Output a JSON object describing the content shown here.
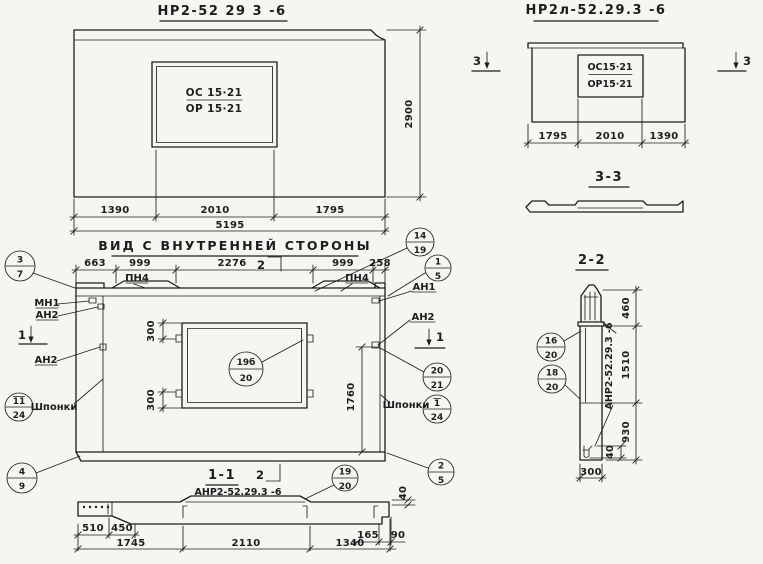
{
  "paper_color": "#f6f5f1",
  "ink_color": "#1d1d1d",
  "front_left": {
    "title": "НР2-52 29 3 -6",
    "opening_top": "ОС 15·21",
    "opening_bottom": "ОР 15·21",
    "dim_left": "1390",
    "dim_mid": "2010",
    "dim_right": "1795",
    "dim_total": "5195",
    "dim_height": "2900"
  },
  "front_right": {
    "title": "НР2л-52.29.3 -6",
    "opening_top": "ОС15·21",
    "opening_bottom": "ОР15·21",
    "dim_left": "1795",
    "dim_mid": "2010",
    "dim_right": "1390",
    "cut_label": "3",
    "section_title": "3-3"
  },
  "inner": {
    "title": "ВИД С ВНУТРЕННЕЙ СТОРОНЫ",
    "dims_top": {
      "d1": "663",
      "d2": "999",
      "d3": "2276",
      "d4": "999",
      "d5": "258"
    },
    "dim_300": "300",
    "dim_1760": "1760",
    "labels": {
      "pn4": "ПН4",
      "mn1": "МН1",
      "an1": "АН1",
      "an2": "АН2",
      "shponki": "Шпонки"
    },
    "cut1": "1",
    "cut2": "2"
  },
  "s11": {
    "title": "1-1",
    "cut2": "2",
    "mark": "АНР2-52.29.3 -6",
    "dims": {
      "d510": "510",
      "d450": "450",
      "d1745": "1745",
      "d2110": "2110",
      "d1340": "1340",
      "d165": "165",
      "d90": "90",
      "d40": "40"
    }
  },
  "s22": {
    "title": "2-2",
    "mark": "АНР2-52.29.3 -6",
    "dims": {
      "d460": "460",
      "d1510": "1510",
      "d930": "930",
      "d40": "40",
      "d300": "300"
    }
  },
  "balloons": {
    "b3_7": {
      "t": "3",
      "b": "7"
    },
    "b14_19": {
      "t": "14",
      "b": "19"
    },
    "b1_5": {
      "t": "1",
      "b": "5"
    },
    "b20_21": {
      "t": "20",
      "b": "21"
    },
    "b1o_24": {
      "t": "1",
      "b": "24",
      "overbar": true
    },
    "b11o_24": {
      "t": "11",
      "b": "24",
      "overbar": true
    },
    "b4_9": {
      "t": "4",
      "b": "9"
    },
    "b19b_20": {
      "t": "19б",
      "b": "20"
    },
    "b19_20": {
      "t": "19",
      "b": "20"
    },
    "b2_5": {
      "t": "2",
      "b": "5"
    },
    "b16_20": {
      "t": "16",
      "b": "20"
    },
    "b18_20": {
      "t": "18",
      "b": "20"
    }
  }
}
